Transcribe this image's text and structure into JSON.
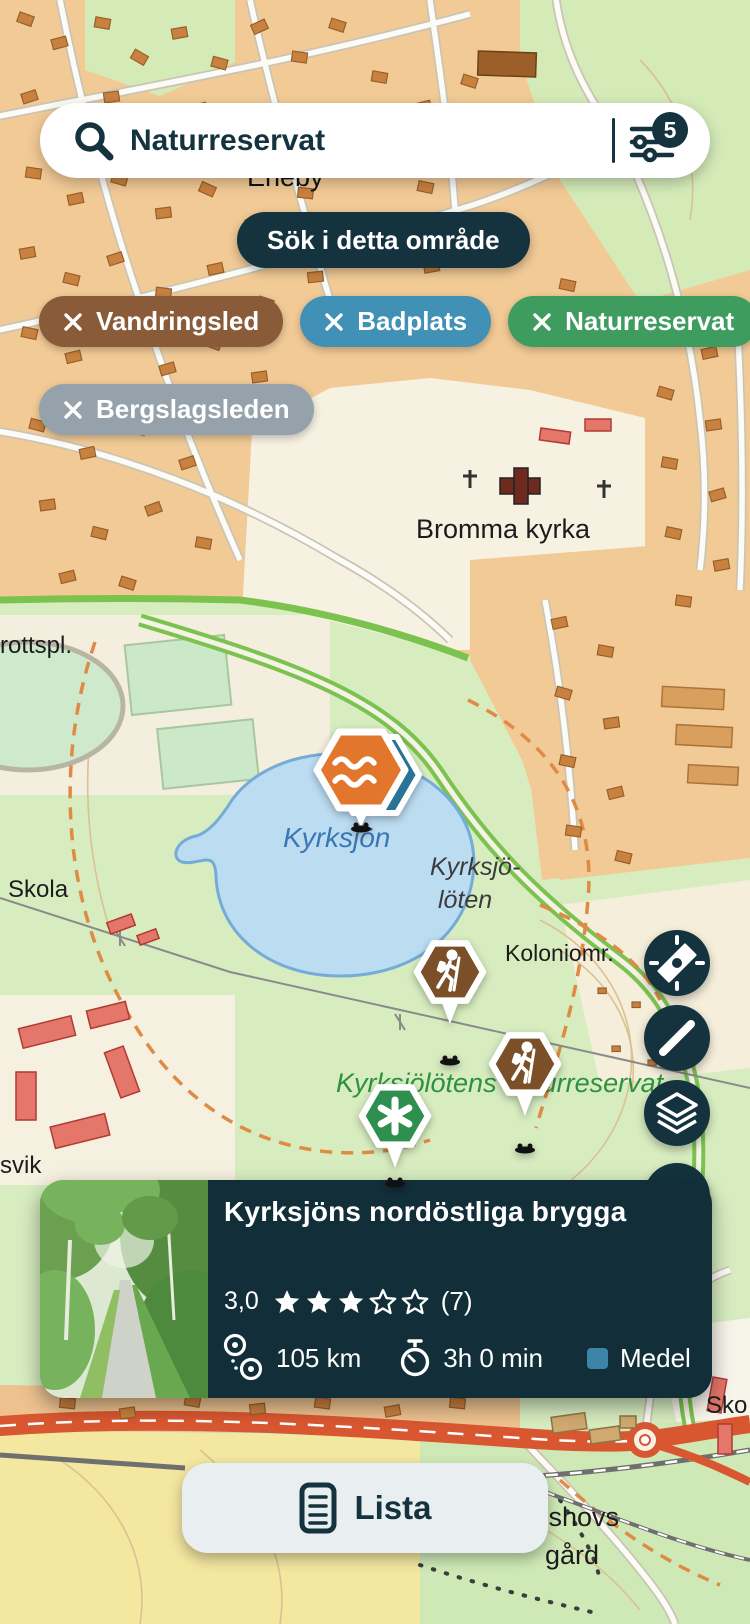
{
  "search_bar": {
    "query": "Naturreservat",
    "filter_badge": "5"
  },
  "buttons": {
    "search_area": "Sök i detta område",
    "list": "Lista"
  },
  "filter_chips": [
    {
      "label": "Vandringsled",
      "color": "#8a5b38"
    },
    {
      "label": "Badplats",
      "color": "#4190b5"
    },
    {
      "label": "Naturreservat",
      "color": "#3d9c5e"
    },
    {
      "label": "Bergslagsleden",
      "color": "#95a2ac"
    }
  ],
  "map_labels": {
    "eneby": "Eneby",
    "idrottsplats": "rottspl.",
    "bromma_kyrka": "Bromma kyrka",
    "kyrksjon": "Kyrksjön",
    "kyrksjoloten_line1": "Kyrksjö-",
    "kyrksjoloten_line2": "löten",
    "skola": "Skola",
    "koloniomrade": "Koloniomr.",
    "naturreservat": "Kyrksjölötens naturreservat",
    "svik": "svik",
    "akeshovs_line1": "Åkeshovs",
    "akeshovs_line2": "gård",
    "skola_right": "Sko"
  },
  "map_markers": [
    {
      "type": "badplats-swimming",
      "color": "#e2762c"
    },
    {
      "type": "vandringsled-hiking",
      "color": "#7b4f28"
    },
    {
      "type": "vandringsled-hiking",
      "color": "#7b4f28"
    },
    {
      "type": "naturreservat",
      "color": "#2f8f4e"
    }
  ],
  "map_controls": [
    "compass",
    "measure",
    "layers"
  ],
  "card": {
    "title": "Kyrksjöns nordöstliga brygga",
    "rating_value": "3,0",
    "rating_stars_filled": 3,
    "rating_stars_total": 5,
    "rating_count": "(7)",
    "distance": "105 km",
    "duration": "3h 0 min",
    "difficulty_label": "Medel",
    "difficulty_color": "#3d85a8"
  }
}
